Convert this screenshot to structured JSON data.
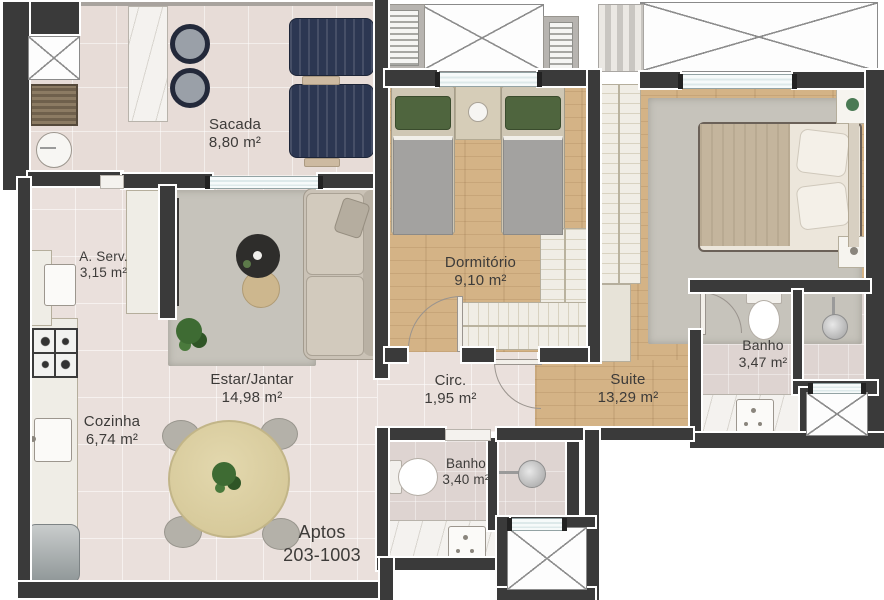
{
  "plan": {
    "title": "apartment-floor-plan",
    "rooms": {
      "sacada": {
        "label": "Sacada",
        "area": "8,80 m²"
      },
      "aserv": {
        "label": "A. Serv.",
        "area": "3,15 m²"
      },
      "dormitorio": {
        "label": "Dormitório",
        "area": "9,10 m²"
      },
      "estar": {
        "label": "Estar/Jantar",
        "area": "14,98 m²"
      },
      "cozinha": {
        "label": "Cozinha",
        "area": "6,74 m²"
      },
      "circ": {
        "label": "Circ.",
        "area": "1,95 m²"
      },
      "suite": {
        "label": "Suite",
        "area": "13,29 m²"
      },
      "banho_suite": {
        "label": "Banho",
        "area": "3,47 m²"
      },
      "banho_social": {
        "label": "Banho",
        "area": "3,40 m²"
      }
    },
    "units_label": {
      "line1": "Aptos",
      "line2": "203-1003"
    },
    "colors": {
      "wall": "#3a3a3a",
      "floor_tile": "#eae0dc",
      "floor_wood": "#d4b386",
      "floor_bath": "#ded4d1",
      "floor_balcony": "#e7dcd7",
      "rug": "#c6c3bb",
      "lounge_chair_navy": "#2c3752",
      "marble": "#f4f2ef",
      "dining_table": "#ddd1a4",
      "plant_green": "#3e6b33",
      "text": "#3d3b39"
    }
  }
}
